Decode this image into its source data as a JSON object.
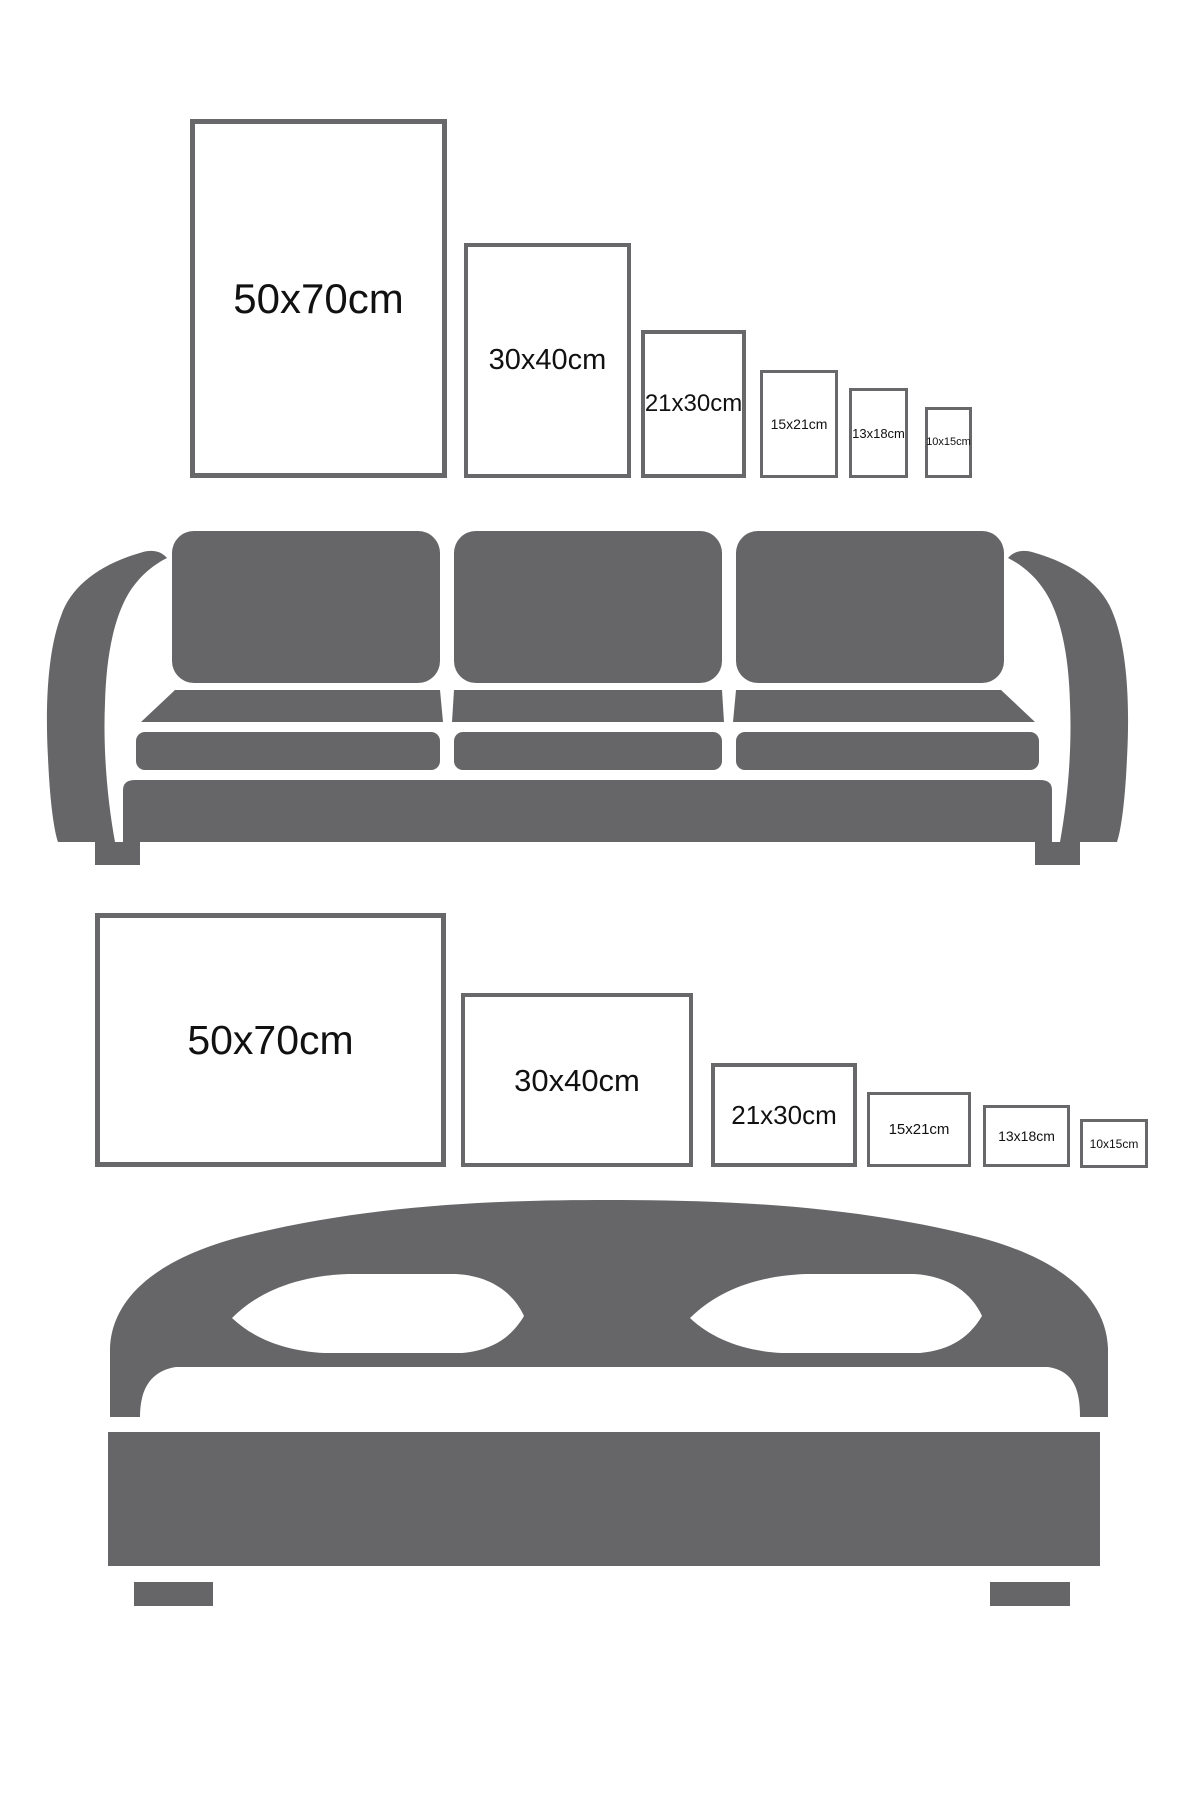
{
  "canvas": {
    "width": 1200,
    "height": 1800,
    "background": "#ffffff"
  },
  "colors": {
    "furniture": "#666668",
    "frame_border": "#68686a",
    "label": "#111111"
  },
  "top_section": {
    "furniture": "sofa",
    "orientation": "portrait",
    "frames": [
      {
        "label": "50x70cm"
      },
      {
        "label": "30x40cm"
      },
      {
        "label": "21x30cm"
      },
      {
        "label": "15x21cm"
      },
      {
        "label": "13x18cm"
      },
      {
        "label": "10x15cm"
      }
    ]
  },
  "bottom_section": {
    "furniture": "bed",
    "orientation": "landscape",
    "frames": [
      {
        "label": "50x70cm"
      },
      {
        "label": "30x40cm"
      },
      {
        "label": "21x30cm"
      },
      {
        "label": "15x21cm"
      },
      {
        "label": "13x18cm"
      },
      {
        "label": "10x15cm"
      }
    ]
  }
}
